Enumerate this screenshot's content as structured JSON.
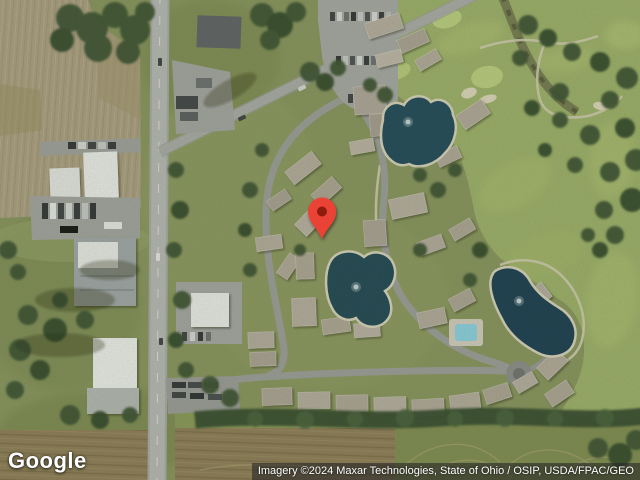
{
  "branding": {
    "logo_text": "Google"
  },
  "attribution": {
    "text": "Imagery ©2024 Maxar Technologies, State of Ohio / OSIP, USDA/FPAC/GEO"
  },
  "marker": {
    "color": "#EA4335",
    "inner_color": "#8E1A10"
  },
  "scene_palette": {
    "grass": "#87945c",
    "golf_green": "#9db169",
    "putting_green": "#bcd07f",
    "field_tan": "#ab9e81",
    "field_brown": "#8d7c56",
    "pond_teal": "#1c4759",
    "road_gray": "#b6b8b5",
    "tree_green": "#3a5130"
  }
}
